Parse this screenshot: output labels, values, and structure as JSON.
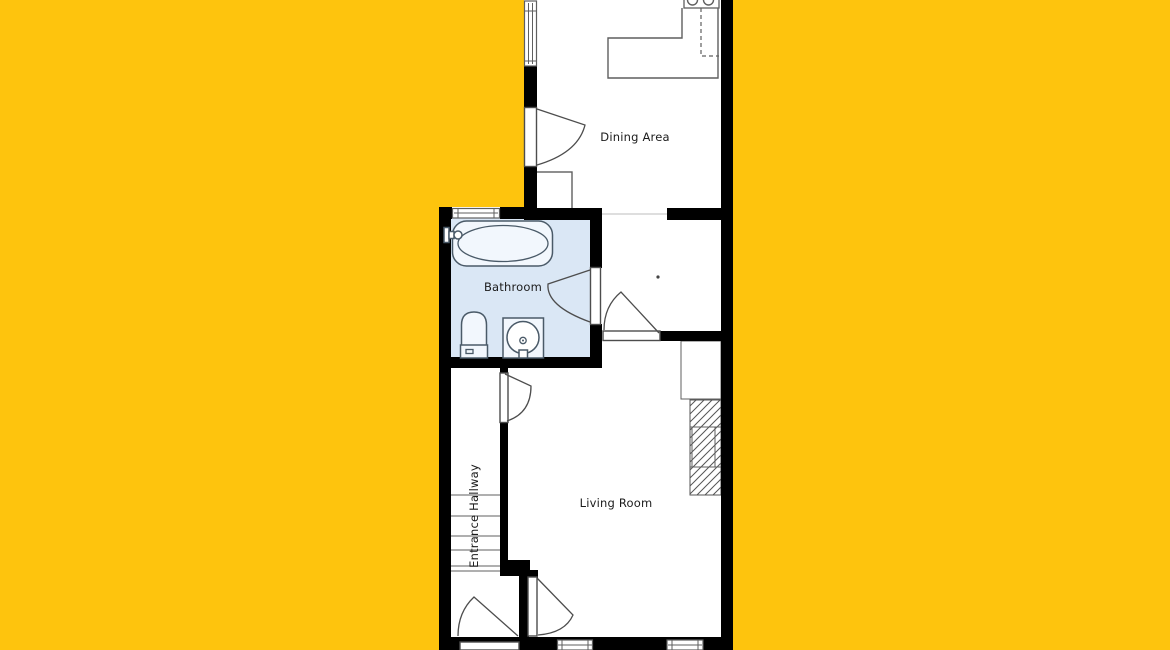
{
  "rooms": {
    "dining": "Dining Area",
    "bathroom": "Bathroom",
    "living": "Living Room",
    "hallway": "Entrance Hallway"
  },
  "colors": {
    "page_background": "#FEC40D",
    "wall": "#000000",
    "room_fill": "#FFFFFF",
    "bathroom_fill": "#DAE7F5",
    "fixture_stroke": "#4A5A68",
    "detail_line": "#5F5F5F"
  }
}
